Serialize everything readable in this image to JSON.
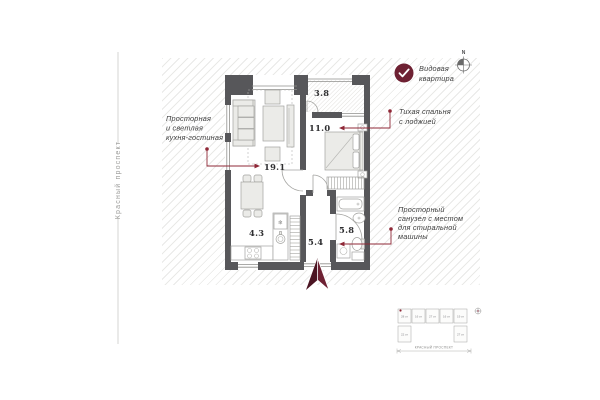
{
  "street": {
    "name": "Красный проспект"
  },
  "badge": {
    "line1": "Видовая",
    "line2": "квартира"
  },
  "compass": {
    "label": "N"
  },
  "rooms": {
    "living": "19.1",
    "bedroom": "11.0",
    "loggia": "3.8",
    "kitchen": "4.3",
    "hall": "5.4",
    "bath": "5.8"
  },
  "annotations": {
    "kitchen": {
      "line1": "Просторная",
      "line2": "и светлая",
      "line3": "кухня-гостиная"
    },
    "bedroom": {
      "line1": "Тихая спальня",
      "line2": "с лоджией"
    },
    "bath": {
      "line1": "Просторный",
      "line2": "санузел с местом",
      "line3": "для стиральной",
      "line4": "машины"
    }
  },
  "site_plan": {
    "blocks_top": [
      "28 эт",
      "16 эт",
      "27 эт",
      "16 эт",
      "19 эт"
    ],
    "blocks_bottom": [
      "22 эт",
      "27 эт"
    ],
    "street_label": "Красный проспект"
  },
  "colors": {
    "accent_dark": "#4b1422",
    "accent": "#6e2133",
    "annotation_red": "#8f2837",
    "wall_gray": "#57575a"
  }
}
